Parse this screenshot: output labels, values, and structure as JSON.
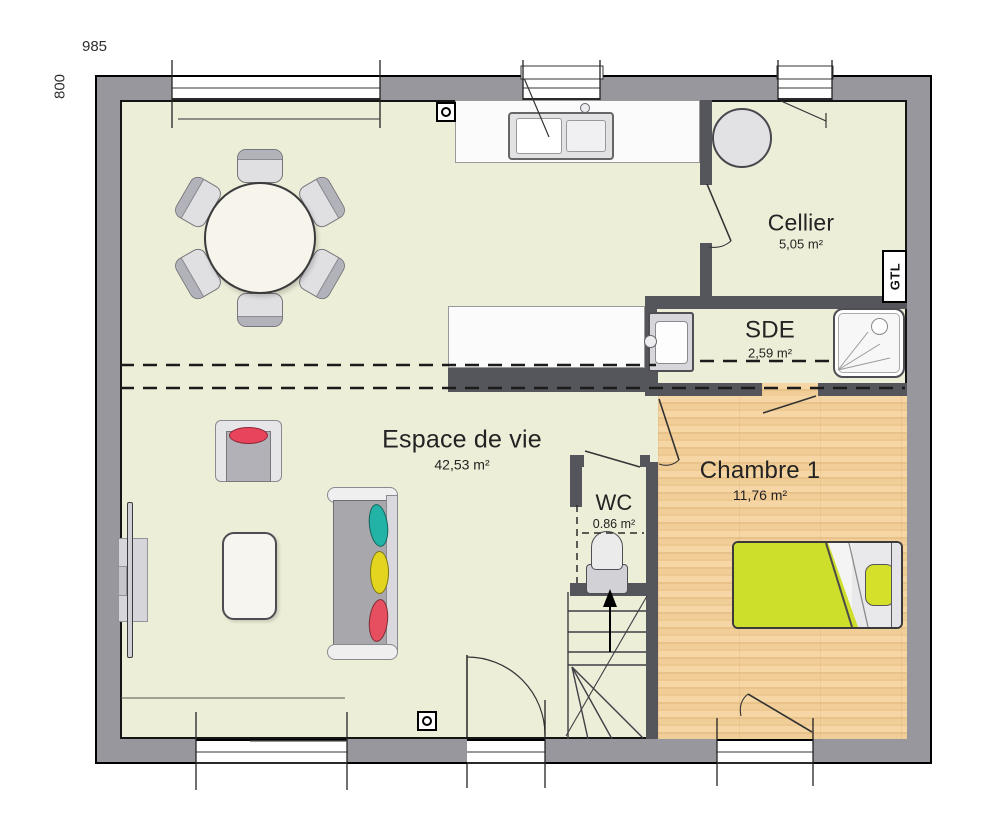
{
  "dimensions": {
    "width": "985",
    "height": "800"
  },
  "rooms": [
    {
      "name": "Espace de vie",
      "area": "42,53 m²"
    },
    {
      "name": "Cellier",
      "area": "5,05 m²"
    },
    {
      "name": "SDE",
      "area": "2,59 m²"
    },
    {
      "name": "WC",
      "area": "0.86 m²"
    },
    {
      "name": "Chambre 1",
      "area": "11,76 m²"
    }
  ],
  "annotations": {
    "gtl": "GTL"
  },
  "furniture_icons": [
    "round-dining-table",
    "dining-chair",
    "kitchen-counter",
    "kitchen-sink",
    "island-counter",
    "armchair",
    "sofa",
    "sofa-pillows",
    "coffee-table",
    "tv-unit",
    "water-heater",
    "washbasin",
    "shower-tray",
    "toilet",
    "double-bed",
    "staircase",
    "structural-post"
  ],
  "colors": {
    "floor": "#edeed8",
    "wood_floor": "#f1cd97",
    "exterior_wall": "#97979d",
    "interior_wall": "#55555c",
    "bed_cover": "#cdde2b",
    "pillow_teal": "#23b2a6",
    "pillow_yellow": "#e3d51f",
    "pillow_red": "#e64f60",
    "armchair_cushion": "#e8455c"
  }
}
